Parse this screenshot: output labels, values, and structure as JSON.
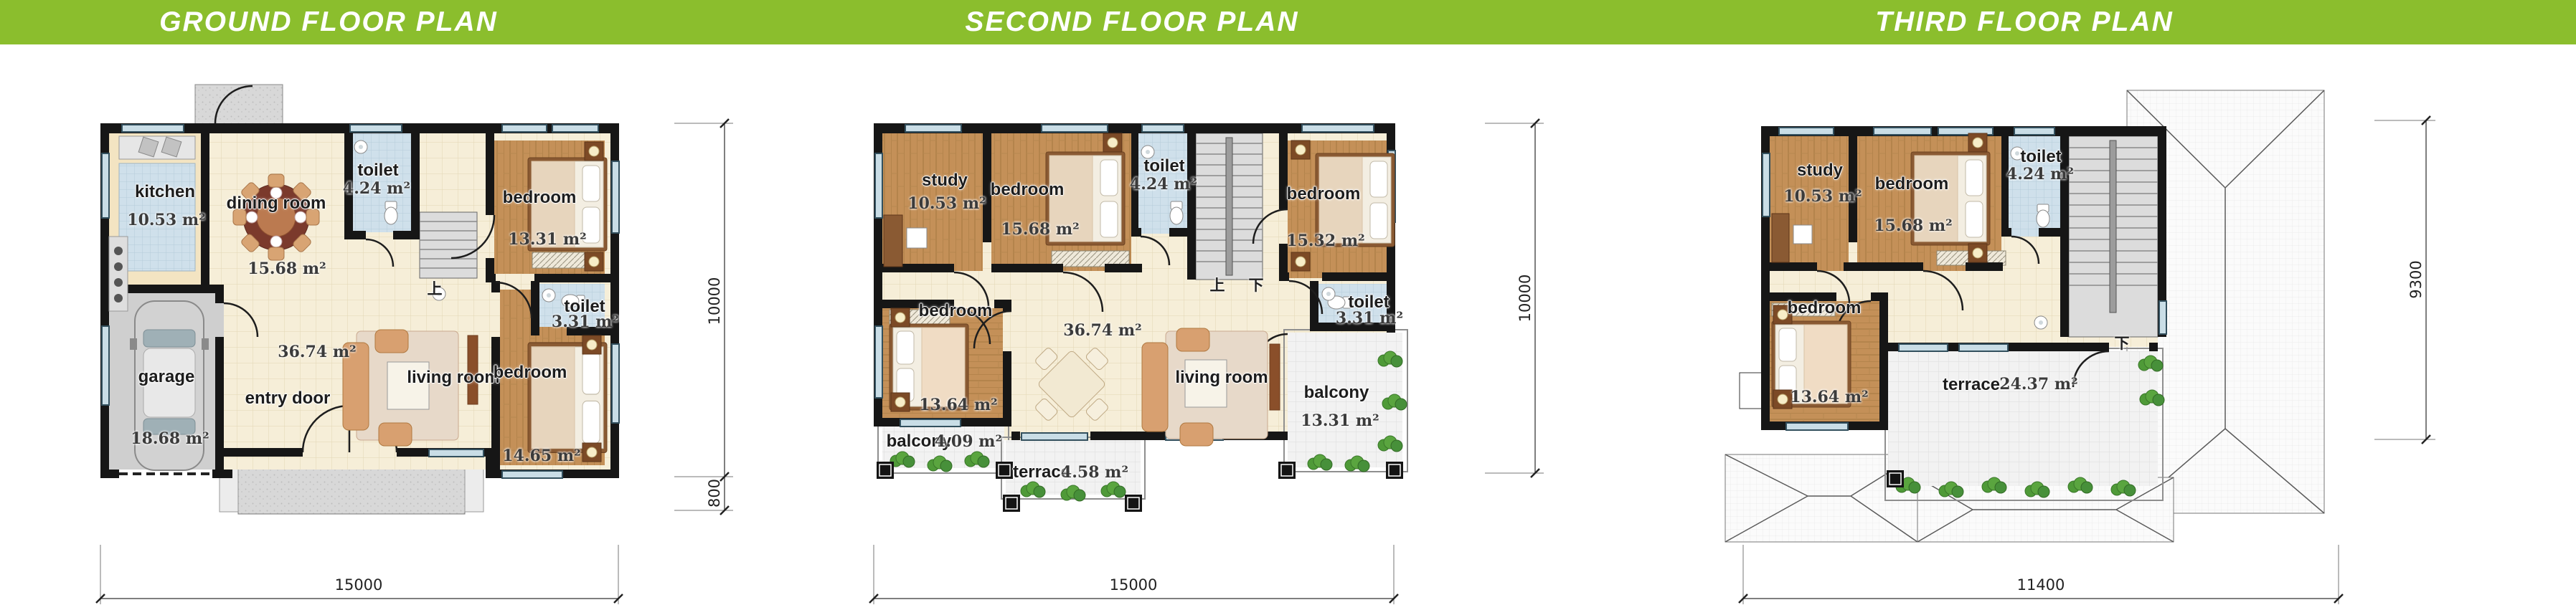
{
  "header": {
    "bar_color": "#8BBE2D",
    "titles": [
      "GROUND FLOOR PLAN",
      "SECOND FLOOR PLAN",
      "THIRD FLOOR PLAN"
    ]
  },
  "units_label": "m²",
  "plans": {
    "ground": {
      "title": "GROUND FLOOR PLAN",
      "rooms": {
        "kitchen": {
          "name": "kitchen",
          "area": "10.53 m²"
        },
        "dining": {
          "name": "dining room",
          "area": "15.68 m²"
        },
        "toilet_top": {
          "name": "toilet",
          "area": "4.24 m²"
        },
        "bedroom_top": {
          "name": "bedroom",
          "area": "13.31 m²"
        },
        "toilet_mid": {
          "name": "toilet",
          "area": "3.31 m²"
        },
        "living": {
          "name": "living room",
          "area": "36.74 m²"
        },
        "bedroom_bottom": {
          "name": "bedroom",
          "area": "14.65 m²"
        },
        "garage": {
          "name": "garage",
          "area": "18.68 m²"
        },
        "entry": {
          "name": "entry door"
        }
      },
      "stair_up": "上",
      "dims": {
        "width": "15000",
        "height": "10000",
        "porch": "800"
      }
    },
    "second": {
      "title": "SECOND FLOOR PLAN",
      "rooms": {
        "study": {
          "name": "study",
          "area": "10.53 m²"
        },
        "bedroom_top": {
          "name": "bedroom",
          "area": "15.68 m²"
        },
        "toilet_top": {
          "name": "toilet",
          "area": "4.24 m²"
        },
        "bedroom_right": {
          "name": "bedroom",
          "area": "15.32 m²"
        },
        "toilet_mid": {
          "name": "toilet",
          "area": "3.31 m²"
        },
        "bedroom_left": {
          "name": "bedroom",
          "area": "13.64 m²"
        },
        "living": {
          "name": "living room",
          "area": "36.74 m²"
        },
        "balcony_left": {
          "name": "balcony",
          "area": "4.09 m²"
        },
        "terrace": {
          "name": "terrace",
          "area": "4.58 m²"
        },
        "balcony_right": {
          "name": "balcony",
          "area": "13.31 m²"
        }
      },
      "stair_up": "上",
      "stair_down": "下",
      "dims": {
        "width": "15000",
        "height": "10000"
      }
    },
    "third": {
      "title": "THIRD FLOOR PLAN",
      "rooms": {
        "study": {
          "name": "study",
          "area": "10.53 m²"
        },
        "bedroom_top": {
          "name": "bedroom",
          "area": "15.68 m²"
        },
        "toilet_top": {
          "name": "toilet",
          "area": "4.24 m²"
        },
        "bedroom_left": {
          "name": "bedroom",
          "area": "13.64 m²"
        },
        "terrace": {
          "name": "terrace",
          "area": "24.37 m²"
        }
      },
      "stair_down": "下",
      "dims": {
        "width": "11400",
        "height": "9300"
      }
    }
  }
}
